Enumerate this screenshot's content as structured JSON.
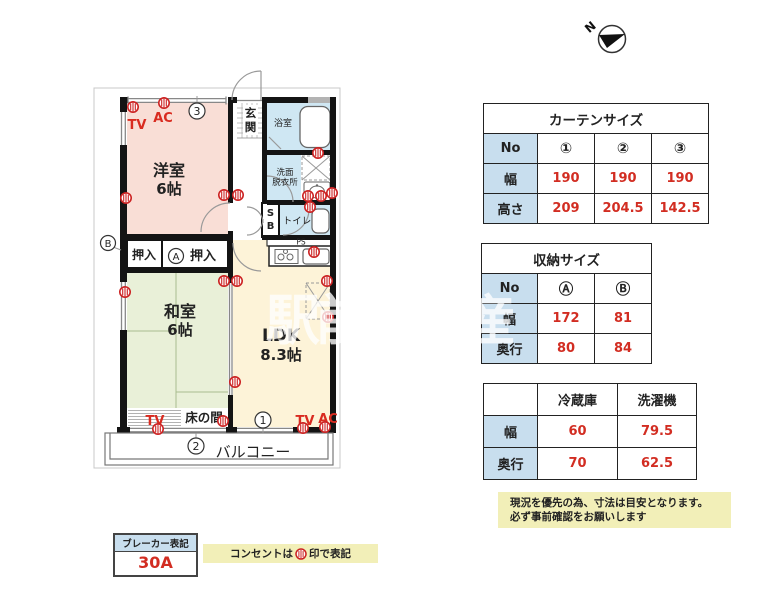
{
  "colors": {
    "accent_red": "#d22d22",
    "wall_black": "#141414",
    "room_pink": "#f9ded6",
    "room_green": "#e9f0d8",
    "room_cream": "#fdf3d8",
    "room_blue": "#cfe7f3",
    "table_header_blue": "#c8deee",
    "note_yellow": "#f2efb8"
  },
  "compass": {
    "north_label": "N"
  },
  "floorplan": {
    "rooms": {
      "yoshitsu_name": "洋室",
      "yoshitsu_size": "6帖",
      "washitsu_name": "和室",
      "washitsu_size": "6帖",
      "ldk_name": "LDK",
      "ldk_size": "8.3帖",
      "genkan_char1": "玄",
      "genkan_char2": "関",
      "bath": "浴室",
      "washroom_line1": "洗面",
      "washroom_line2": "脱衣所",
      "toilet": "トイレ",
      "sb_char1": "S",
      "sb_char2": "B",
      "ps": "PS",
      "closet_left": "押入",
      "closet_right": "押入",
      "tokonoma": "床の間",
      "balcony": "バルコニー"
    },
    "markers": {
      "one": "1",
      "two": "2",
      "three": "3",
      "a": "A",
      "b": "B"
    },
    "labels": {
      "tv1": "TV",
      "ac1": "AC",
      "tv2": "TV",
      "tv3": "TV",
      "ac3": "AC"
    }
  },
  "tables": {
    "curtain": {
      "title": "カーテンサイズ",
      "corner": "No",
      "cols": [
        "①",
        "②",
        "③"
      ],
      "rows": [
        {
          "label": "幅",
          "values": [
            "190",
            "190",
            "190"
          ]
        },
        {
          "label": "高さ",
          "values": [
            "209",
            "204.5",
            "142.5"
          ]
        }
      ]
    },
    "storage": {
      "title": "収納サイズ",
      "corner": "No",
      "cols": [
        "Ⓐ",
        "Ⓑ"
      ],
      "rows": [
        {
          "label": "幅",
          "values": [
            "172",
            "81"
          ]
        },
        {
          "label": "奥行",
          "values": [
            "80",
            "84"
          ]
        }
      ]
    },
    "appliance": {
      "cols": [
        "冷蔵庫",
        "洗濯機"
      ],
      "rows": [
        {
          "label": "幅",
          "values": [
            "60",
            "79.5"
          ]
        },
        {
          "label": "奥行",
          "values": [
            "70",
            "62.5"
          ]
        }
      ]
    }
  },
  "notes": {
    "disclaimer_line1": "現況を優先の為、寸法は目安となります。",
    "disclaimer_line2": "必ず事前確認をお願いします",
    "breaker_label": "ブレーカー表記",
    "breaker_value": "30A",
    "outlet_note_pre": "コンセントは",
    "outlet_note_post": "印で表記"
  },
  "watermark": "駅前不動産"
}
